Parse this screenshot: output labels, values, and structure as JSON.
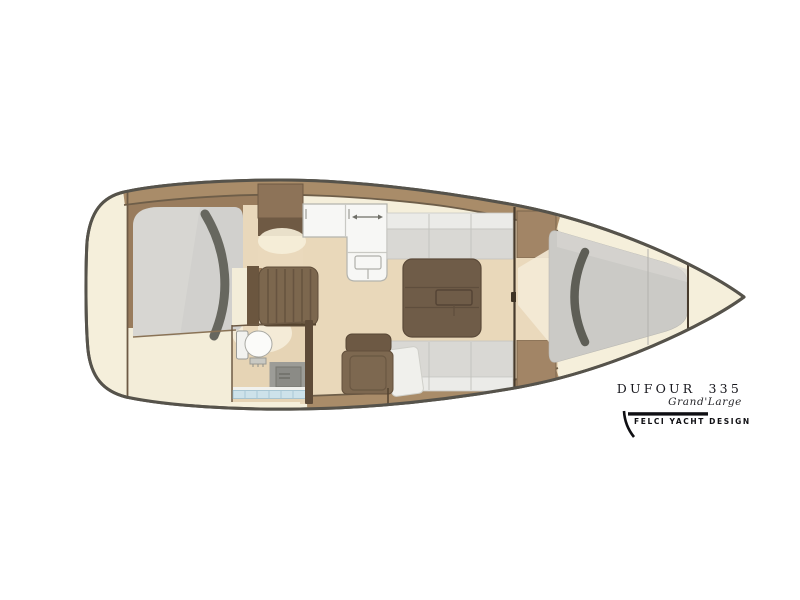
{
  "branding": {
    "model": "DUFOUR 335",
    "series": "Grand'Large",
    "designer": "FELCI YACHT DESIGN"
  },
  "floorplan": {
    "view": "sailboat interior layout plan, top view, bow to the right",
    "areas": [
      {
        "id": "aft-cabin",
        "label": "aft double-berth cabin"
      },
      {
        "id": "wardrobe",
        "label": "wardrobe lockers"
      },
      {
        "id": "galley",
        "label": "L-shaped galley unit"
      },
      {
        "id": "companionway",
        "label": "companionway steps"
      },
      {
        "id": "head",
        "label": "head with toilet and shower"
      },
      {
        "id": "saloon",
        "label": "saloon with twin settees and table"
      },
      {
        "id": "nav-seat",
        "label": "chart seat"
      },
      {
        "id": "forward-cabin",
        "label": "forward V-berth cabin"
      },
      {
        "id": "anchor-locker",
        "label": "bow anchor locker"
      }
    ]
  },
  "colors": {
    "background": "#ffffff",
    "hull_outline": "#56534b",
    "deck_cream": "#f5efdb",
    "floor_tan": "#e9d8ba",
    "wood_band": "#a98c69",
    "wood_dark": "#6e5942",
    "wood_mid": "#8c7357",
    "locker_tan": "#a28566",
    "upholstery_gray": "#d8d7d4",
    "berth_gray": "#cfcecb",
    "pillow_gray": "#64645c",
    "unit_white": "#f7f7f5",
    "table_brown": "#6f5c48",
    "shower_blue": "#cde2ea",
    "text_black": "#111116"
  }
}
